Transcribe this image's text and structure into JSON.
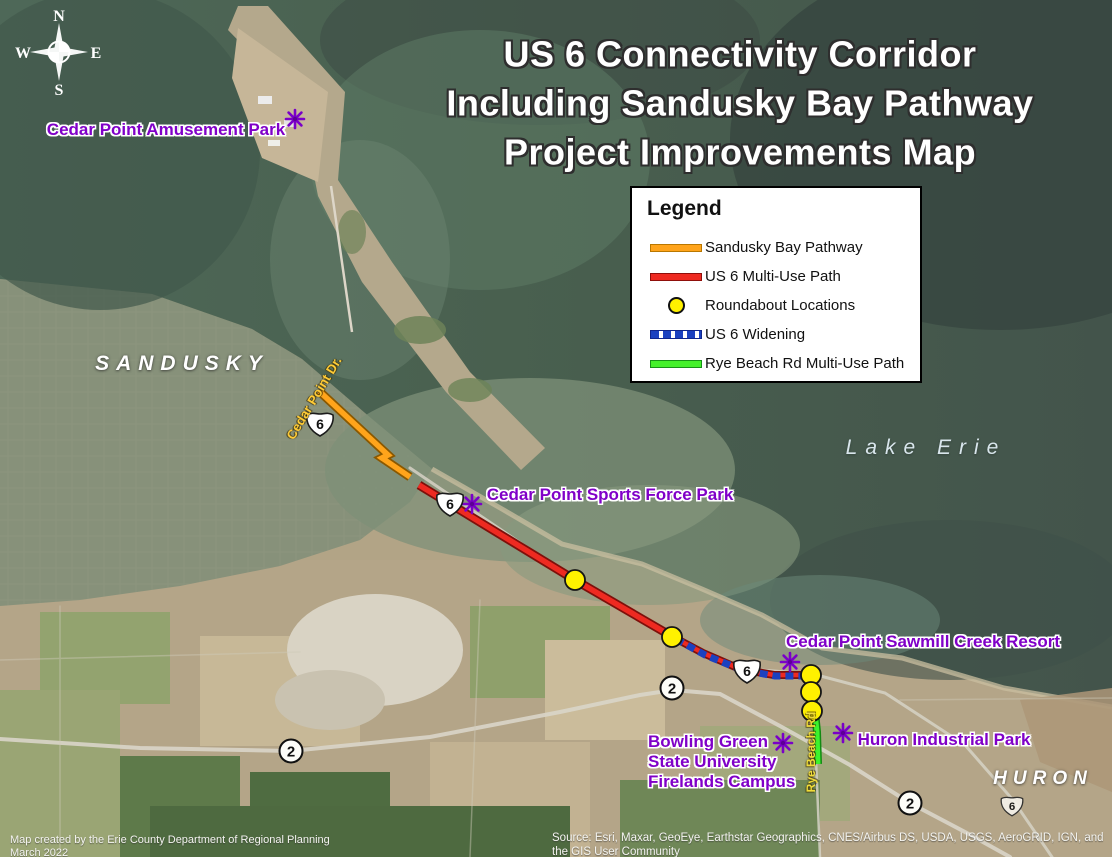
{
  "title": {
    "line1": "US 6 Connectivity Corridor",
    "line2": "Including Sandusky Bay Pathway",
    "line3": "Project Improvements Map"
  },
  "compass": {
    "north": "N",
    "east": "E",
    "south": "S",
    "west": "W"
  },
  "legend": {
    "title": "Legend",
    "items": [
      {
        "label": "Sandusky Bay Pathway",
        "color": "#FFA41B"
      },
      {
        "label": "US 6 Multi-Use Path",
        "color": "#EE2A21"
      },
      {
        "label": "Roundabout Locations",
        "color": "#FFF100"
      },
      {
        "label": "US 6 Widening",
        "color": "#1B41C0"
      },
      {
        "label": "Rye Beach Rd Multi-Use Path",
        "color": "#44F12A"
      }
    ]
  },
  "place_labels": {
    "city_sandusky": "SANDUSKY",
    "city_huron": "HURON",
    "water_body": "Lake Erie"
  },
  "street_labels": {
    "cedar_point_dr": "Cedar Point Dr.",
    "rye_beach_rd": "Rye Beach Rd"
  },
  "poi_labels": {
    "amusement_park": "Cedar Point Amusement Park",
    "sports_force_park": "Cedar Point Sports Force Park",
    "sawmill_resort": "Cedar Point Sawmill Creek Resort",
    "huron_industrial": "Huron Industrial Park",
    "bgsu_line1": "Bowling Green",
    "bgsu_line2": "State University",
    "bgsu_line3": "Firelands Campus"
  },
  "shields": {
    "us6": "6",
    "sr2": "2"
  },
  "credits": {
    "left_line1": "Map created by the Erie County Department of Regional Planning",
    "left_line2": "March 2022",
    "source_line1": "Source: Esri, Maxar, GeoEye, Earthstar Geographics, CNES/Airbus DS, USDA, USGS, AeroGRID, IGN, and",
    "source_line2": "the GIS User Community"
  }
}
